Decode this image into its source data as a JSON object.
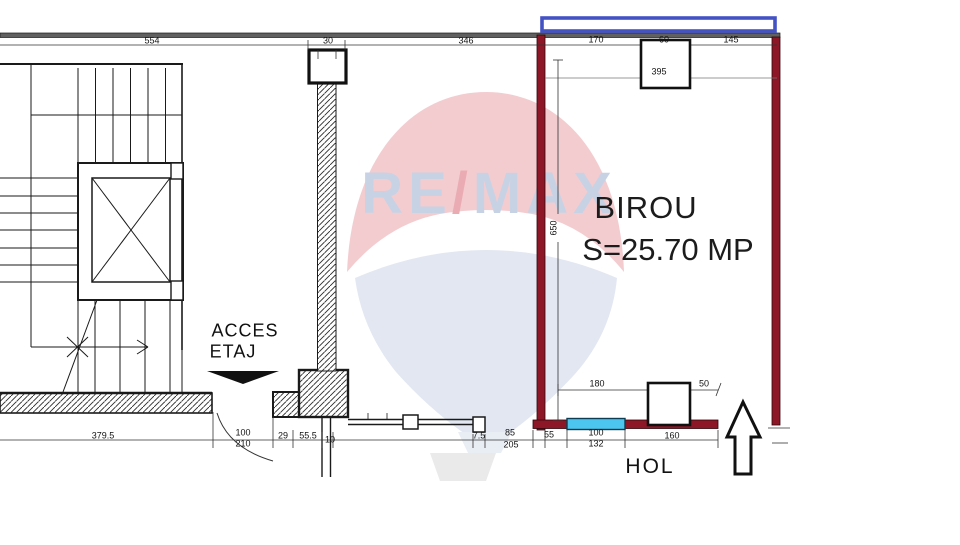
{
  "watermark": {
    "part1": "RE",
    "slash": "/",
    "part2": "MAX"
  },
  "room": {
    "name": "BIROU",
    "area": "S=25.70 MP"
  },
  "texts": {
    "acces1": "ACCES",
    "acces2": "ETAJ",
    "hol": "HOL"
  },
  "dims": {
    "top_554": "554",
    "top_30": "30",
    "top_346": "346",
    "room_170": "170",
    "room_60": "60",
    "room_145": "145",
    "room_395": "395",
    "room_650": "650",
    "room_180": "180",
    "room_50": "50",
    "bot_379_5": "379.5",
    "bot_100a": "100",
    "bot_210": "210",
    "bot_29": "29",
    "bot_55_5": "55.5",
    "bot_10": "10",
    "bot_7_5": "7.5",
    "bot_85": "85",
    "bot_205": "205",
    "bot_55": "55",
    "bot_100b": "100",
    "bot_132": "132",
    "bot_160": "160"
  },
  "colors": {
    "wall_maroon": "#8d1726",
    "glass_cyan": "#4cc6ee",
    "balcony_blue": "#4453c4",
    "top_wall_gray": "#606060",
    "balloon_pink": "#f3ccd0",
    "balloon_blue": "#e2e7f1"
  }
}
